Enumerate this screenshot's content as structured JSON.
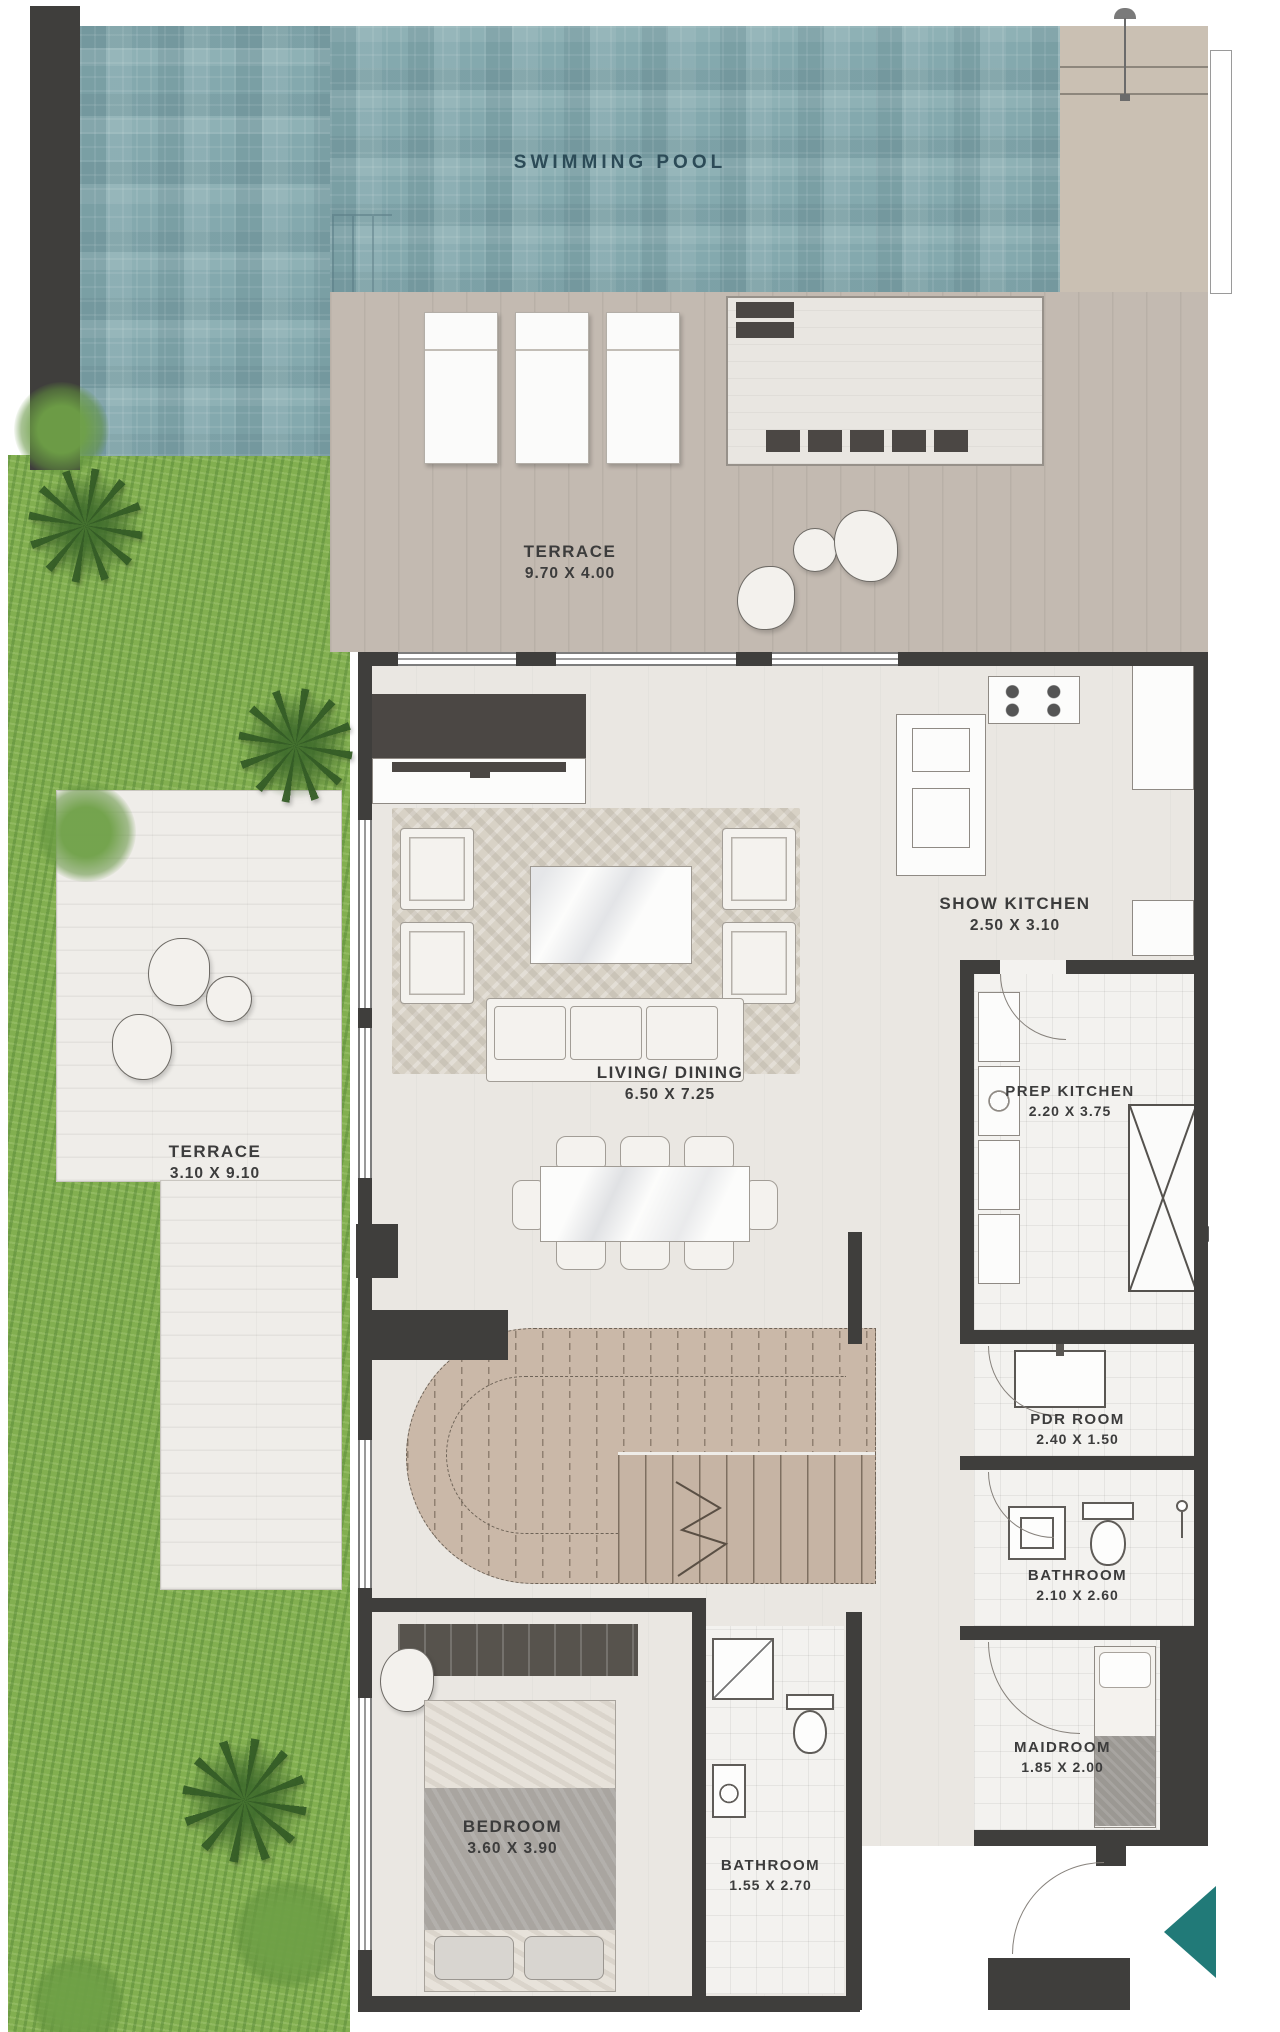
{
  "title": "Villa floor plan",
  "rooms": [
    {
      "id": "swimming-pool",
      "label": "SWIMMING POOL",
      "dims": ""
    },
    {
      "id": "terrace-upper",
      "label": "TERRACE",
      "dims": "9.70 X 4.00"
    },
    {
      "id": "living-dining",
      "label": "LIVING/ DINING",
      "dims": "6.50 X 7.25"
    },
    {
      "id": "show-kitchen",
      "label": "SHOW KITCHEN",
      "dims": "2.50 X 3.10"
    },
    {
      "id": "prep-kitchen",
      "label": "PREP KITCHEN",
      "dims": "2.20 X 3.75"
    },
    {
      "id": "terrace-side",
      "label": "TERRACE",
      "dims": "3.10 X 9.10"
    },
    {
      "id": "pdr-room",
      "label": "PDR ROOM",
      "dims": "2.40 X 1.50"
    },
    {
      "id": "bathroom-upper",
      "label": "BATHROOM",
      "dims": "2.10 X 2.60"
    },
    {
      "id": "maidroom",
      "label": "MAIDROOM",
      "dims": "1.85 X 2.00"
    },
    {
      "id": "bedroom",
      "label": "BEDROOM",
      "dims": "3.60 X 3.90"
    },
    {
      "id": "bathroom-lower",
      "label": "BATHROOM",
      "dims": "1.55 X 2.70"
    }
  ],
  "icons": {
    "entry_arrow": "entry-direction-arrow",
    "section_markers": "section-marker",
    "stair_break": "stair-break-line",
    "shaft_cross": "shaft-x-brace"
  },
  "colors": {
    "pool": "#84a9ae",
    "grass": "#82af50",
    "deck": "#c3bab1",
    "deck_tan": "#cac0b3",
    "white_deck": "#efede9",
    "floor": "#eae7e2",
    "tile": "#f3f2ef",
    "wall": "#3f3e3c",
    "stair": "#cab8a8",
    "accent": "#217a78",
    "label": "#3c3c3c",
    "pool_label": "#2c4b57",
    "furniture_dark": "#4b4744"
  }
}
